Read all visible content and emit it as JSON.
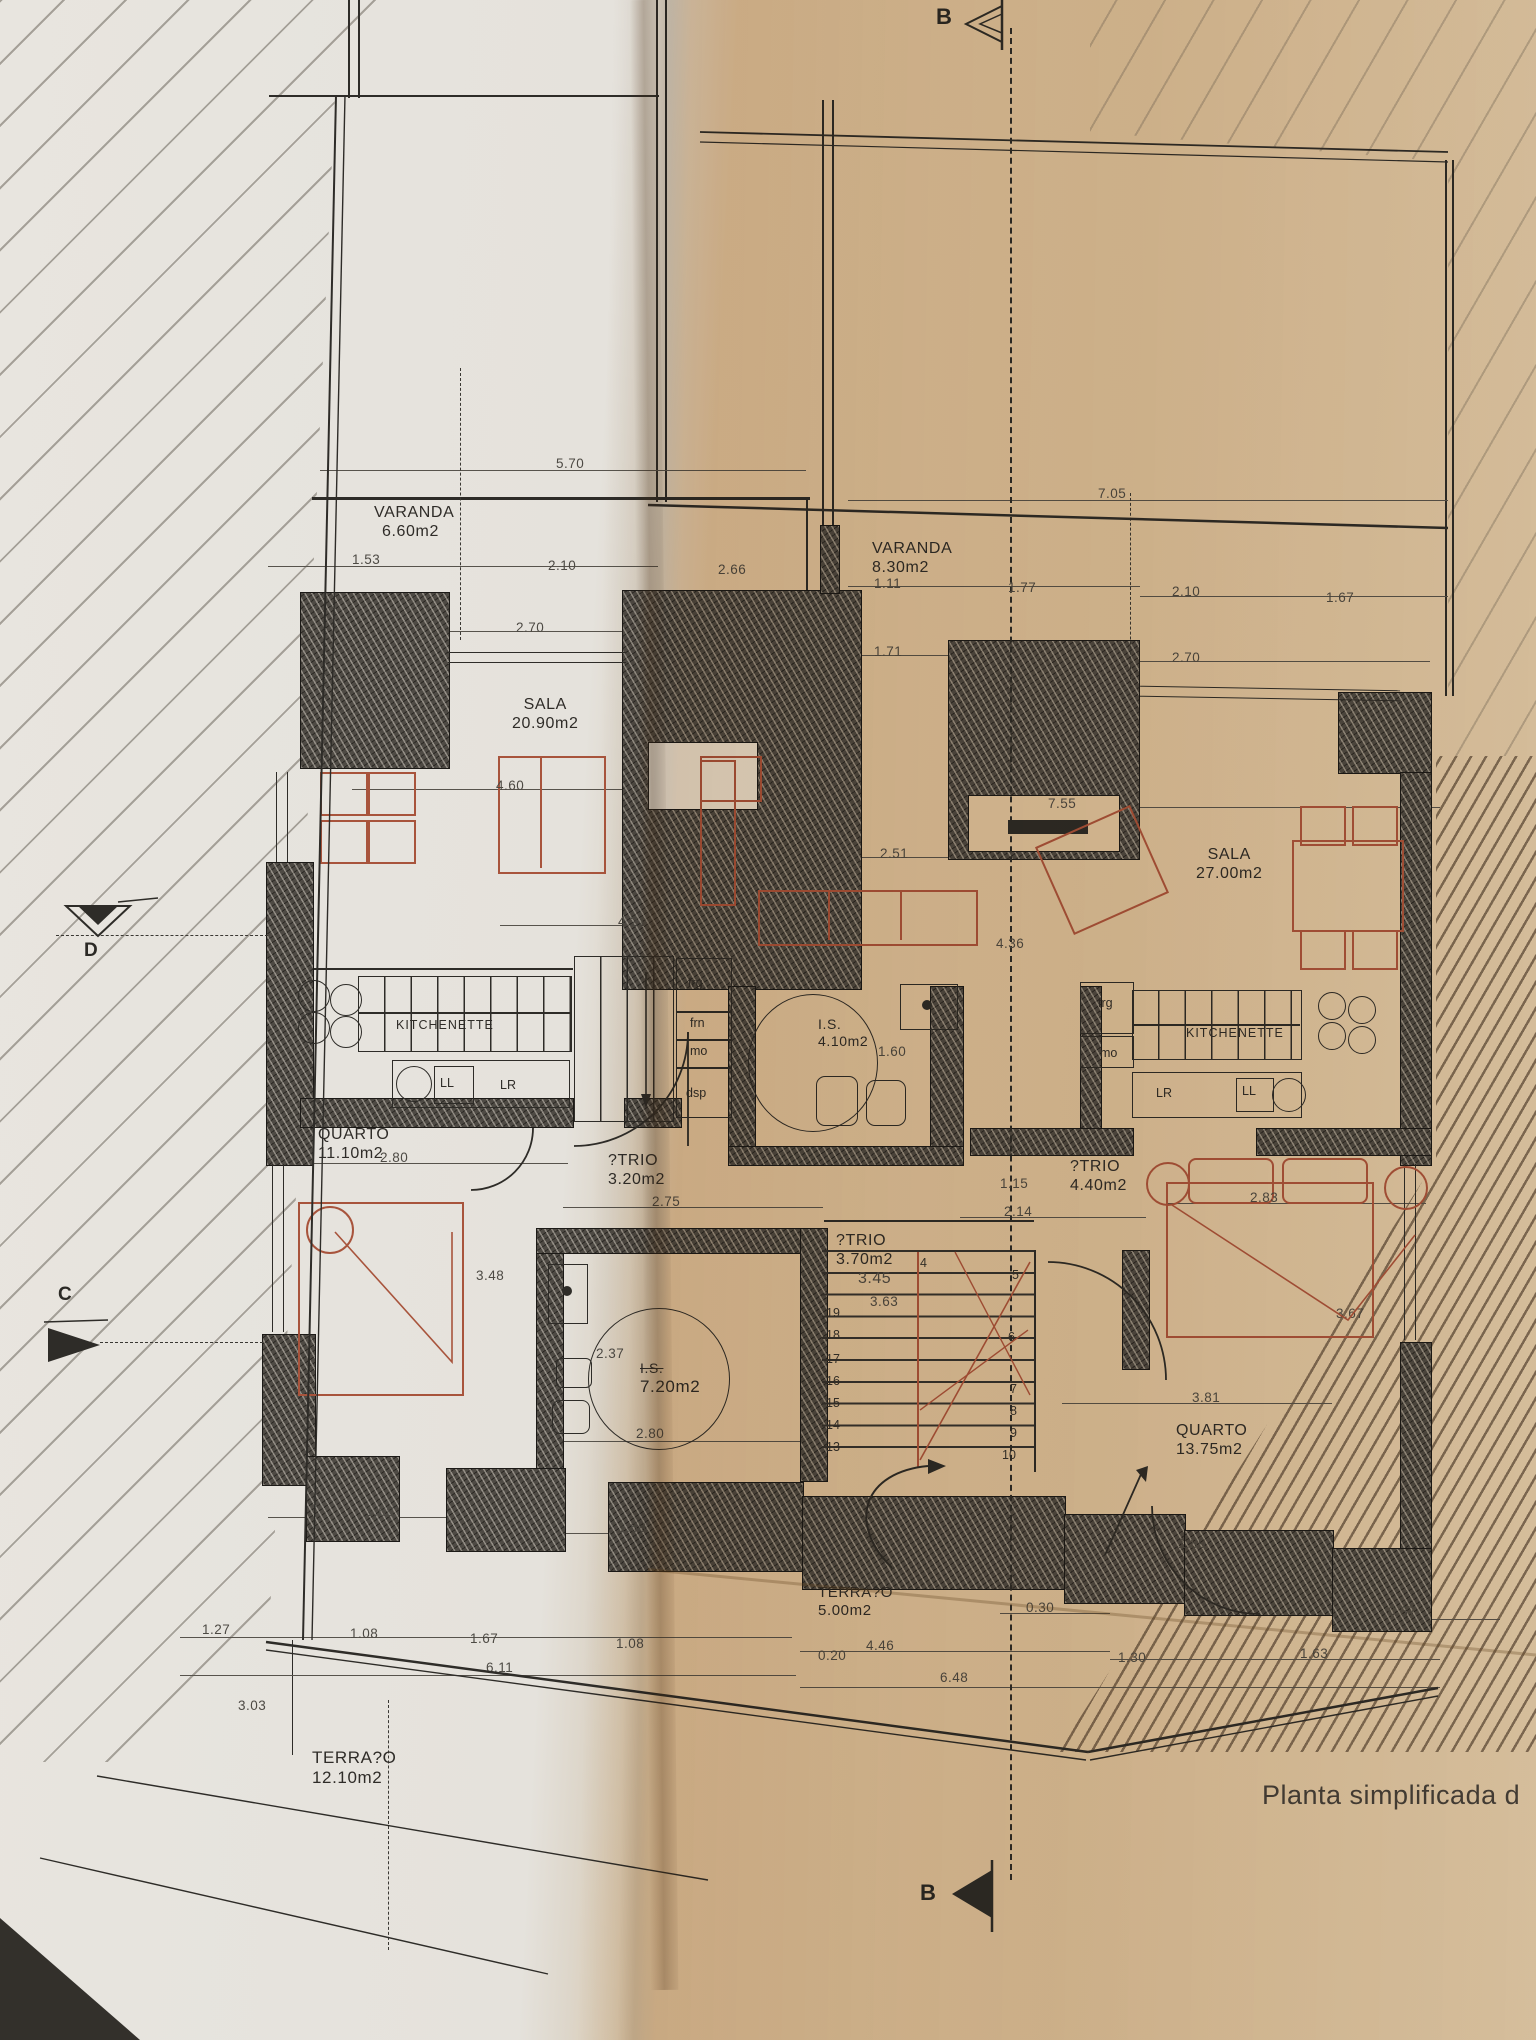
{
  "caption": "Planta simplificada d",
  "markers": {
    "b_top": "B",
    "b_bottom": "B",
    "c": "C",
    "d": "D"
  },
  "rooms": {
    "varanda_left": {
      "name": "VARANDA",
      "area": "6.60m2"
    },
    "varanda_right": {
      "name": "VARANDA",
      "area": "8.30m2"
    },
    "sala_left": {
      "name": "SALA",
      "area": "20.90m2"
    },
    "sala_right": {
      "name": "SALA",
      "area": "27.00m2"
    },
    "quarto_left": {
      "name": "QUARTO",
      "area": "11.10m2"
    },
    "quarto_right": {
      "name": "QUARTO",
      "area": "13.75m2"
    },
    "atrio_left": {
      "name": "?TRIO",
      "area": "3.20m2"
    },
    "atrio_mid": {
      "name": "?TRIO",
      "area": "3.70m2"
    },
    "atrio_right": {
      "name": "?TRIO",
      "area": "4.40m2"
    },
    "is_mid": {
      "name": "I.S.",
      "area": "4.10m2"
    },
    "is_left": {
      "name": "I.S.",
      "area": "7.20m2"
    },
    "terraco_mid": {
      "name": "TERRA?O",
      "area": "5.00m2"
    },
    "terraco_left": {
      "name": "TERRA?O",
      "area": "12.10m2"
    }
  },
  "kitchen": {
    "left_label": "KITCHENETTE",
    "right_label": "KITCHENETTE",
    "frg": "frg",
    "frn": "frn",
    "mo": "mo",
    "dsp": "dsp",
    "ll": "LL",
    "lr": "LR"
  },
  "dims": [
    "5.70",
    "7.05",
    "1.53",
    "2.10",
    "2.66",
    "1.11",
    "1.77",
    "2.10",
    "1.67",
    "2.70",
    "1.71",
    "2.70",
    "4.60",
    "2.51",
    "7.55",
    "4.21",
    "4.36",
    "1.60",
    "2.80",
    "2.75",
    "1.15",
    "2.14",
    "2.83",
    "3.48",
    "3.45",
    "3.63",
    "3.67",
    "2.37",
    "2.80",
    "3.81",
    "1.68",
    "1.68",
    "1.89",
    "0.30",
    "0.37",
    "1.27",
    "1.08",
    "1.67",
    "1.08",
    "0.20",
    "4.46",
    "1.30",
    "1.63",
    "6.11",
    "6.48",
    "3.03"
  ],
  "stairs": {
    "left": [
      "19",
      "18",
      "17",
      "16",
      "15",
      "14",
      "13"
    ],
    "right": [
      "4",
      "5",
      "6",
      "7",
      "8",
      "9",
      "10"
    ]
  },
  "colors": {
    "accent_red": "#a8543c",
    "ink": "#2e2c28",
    "paper_warm": "#d9c3a2"
  }
}
